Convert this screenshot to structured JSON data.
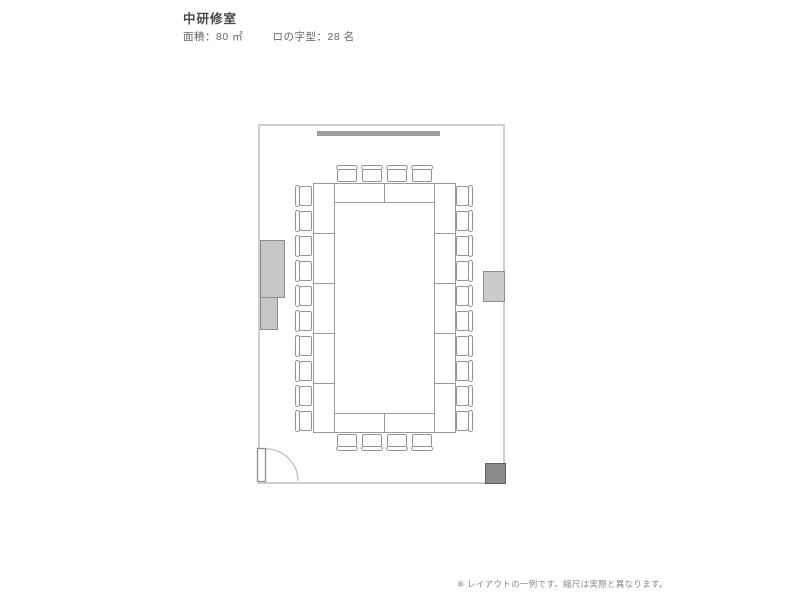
{
  "page": {
    "title": "中研修室",
    "specs": {
      "area": "面積：80 ㎡",
      "layout": "ロの字型：28 名"
    },
    "footnote": "※ レイアウトの一例です。縮尺は実際と異なります。"
  },
  "floorplan": {
    "room_name": "中研修室",
    "area_sqm": 80,
    "layout_type": "ロの字型",
    "capacity": 28,
    "seats": {
      "top": 4,
      "bottom": 4,
      "left": 10,
      "right": 10
    },
    "table_units": {
      "top": 2,
      "bottom": 2,
      "left": 5,
      "right": 5
    },
    "fixtures": [
      "whiteboard",
      "wall-cabinet-upper",
      "wall-cabinet-lower",
      "wall-panel-right",
      "corner-equipment",
      "door"
    ],
    "colors": {
      "wall_outline": "#cfcfcf",
      "furniture_outline": "#9a9a9a",
      "whiteboard_fill": "#9d9d9d",
      "cabinet_fill": "#c6c6c6",
      "corner_equipment_fill": "#8a8a8a",
      "title_text": "#4a4a4a",
      "spec_text": "#666666",
      "footnote_text": "#8a8a8a"
    }
  }
}
